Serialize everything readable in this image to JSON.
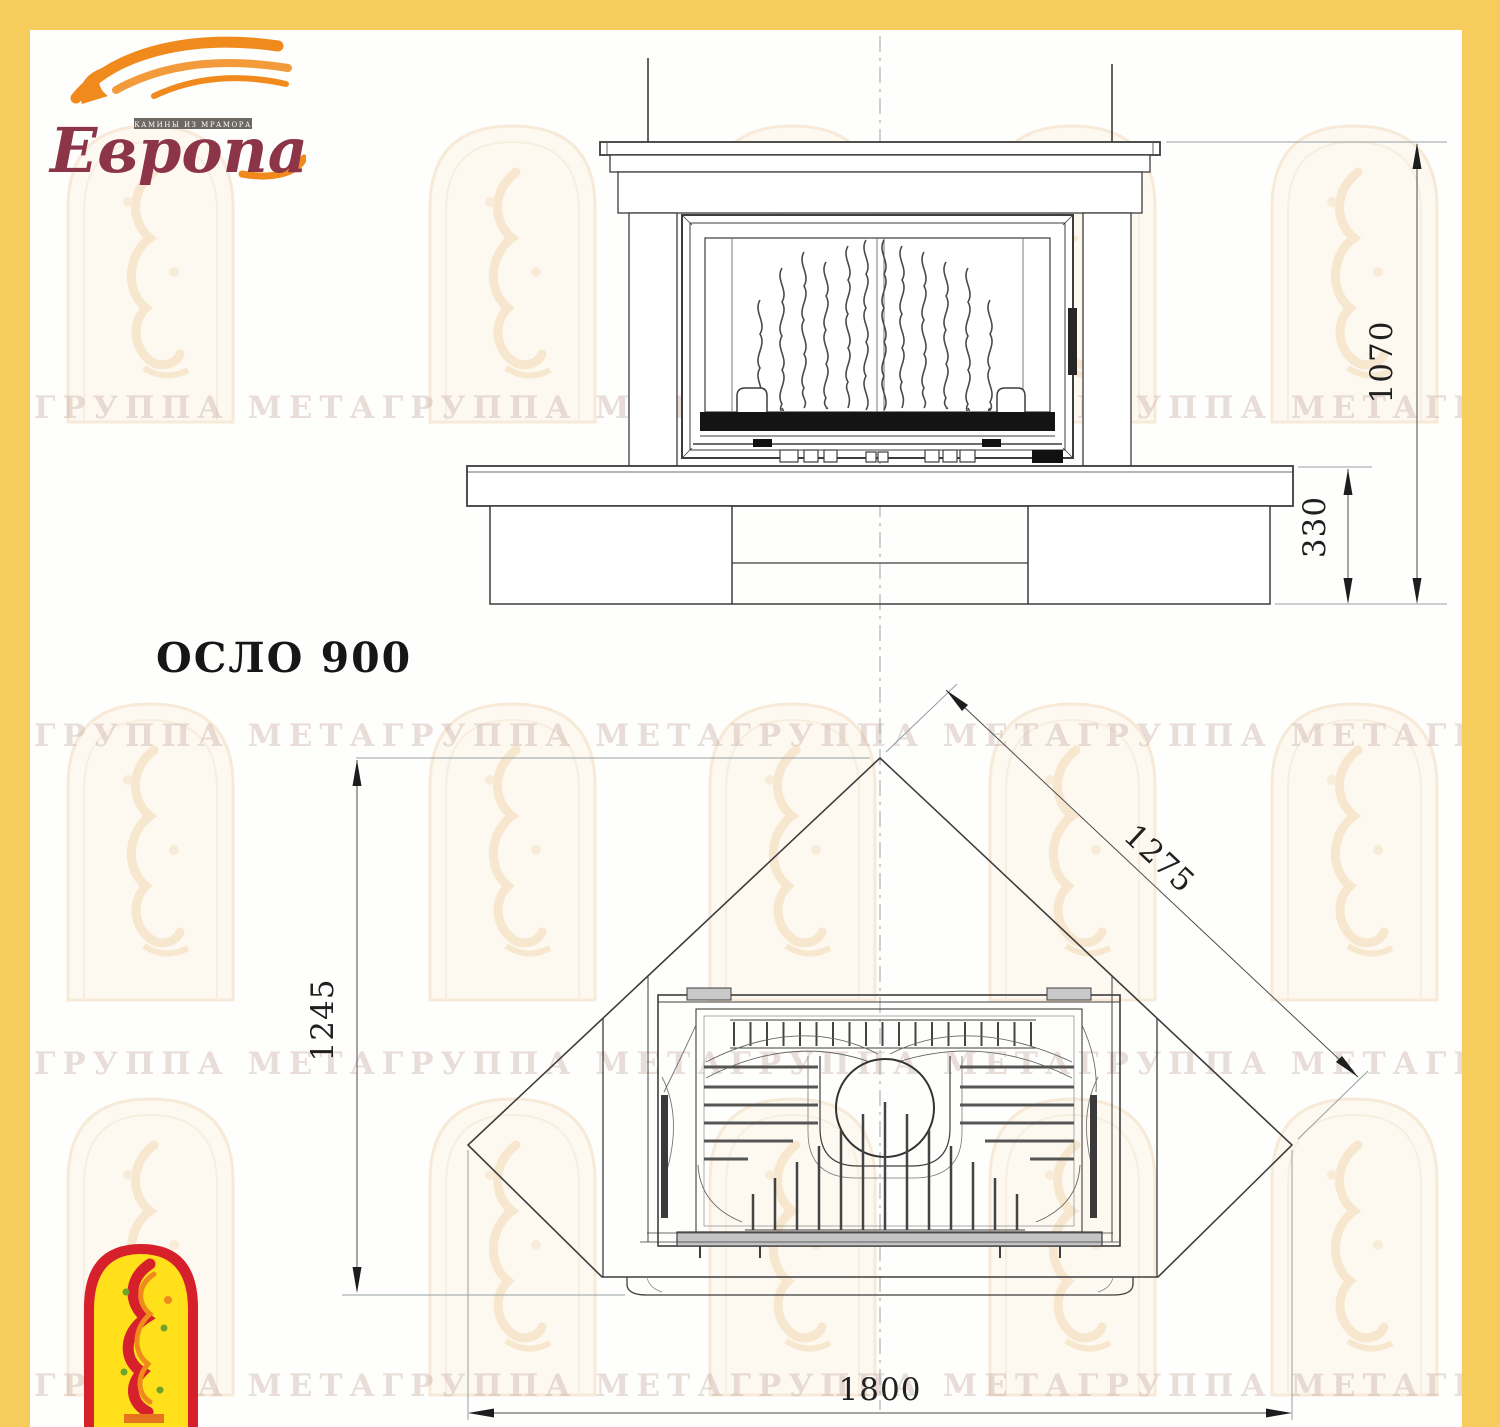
{
  "page": {
    "model_label": "ОСЛО 900"
  },
  "logo": {
    "name": "Европа",
    "tagline": "КАМИНЫ ИЗ МРАМОРА"
  },
  "watermark": {
    "line": "ГРУППА МЕТАГРУППА МЕТАГРУППА МЕТАГРУППА МЕТАГРУППА МЕТА"
  },
  "drawing": {
    "front_view": {
      "height_total_mm": "1070",
      "base_height_mm": "330"
    },
    "plan_view": {
      "width_mm": "1800",
      "depth_mm": "1245",
      "side_mm": "1275"
    }
  },
  "colors": {
    "border_yellow": "#F6CD5C",
    "flame_orange": "#F08A1D",
    "logo_maroon": "#8C3448",
    "emblem_red": "#D6202B",
    "emblem_yellow": "#FFE01A"
  }
}
